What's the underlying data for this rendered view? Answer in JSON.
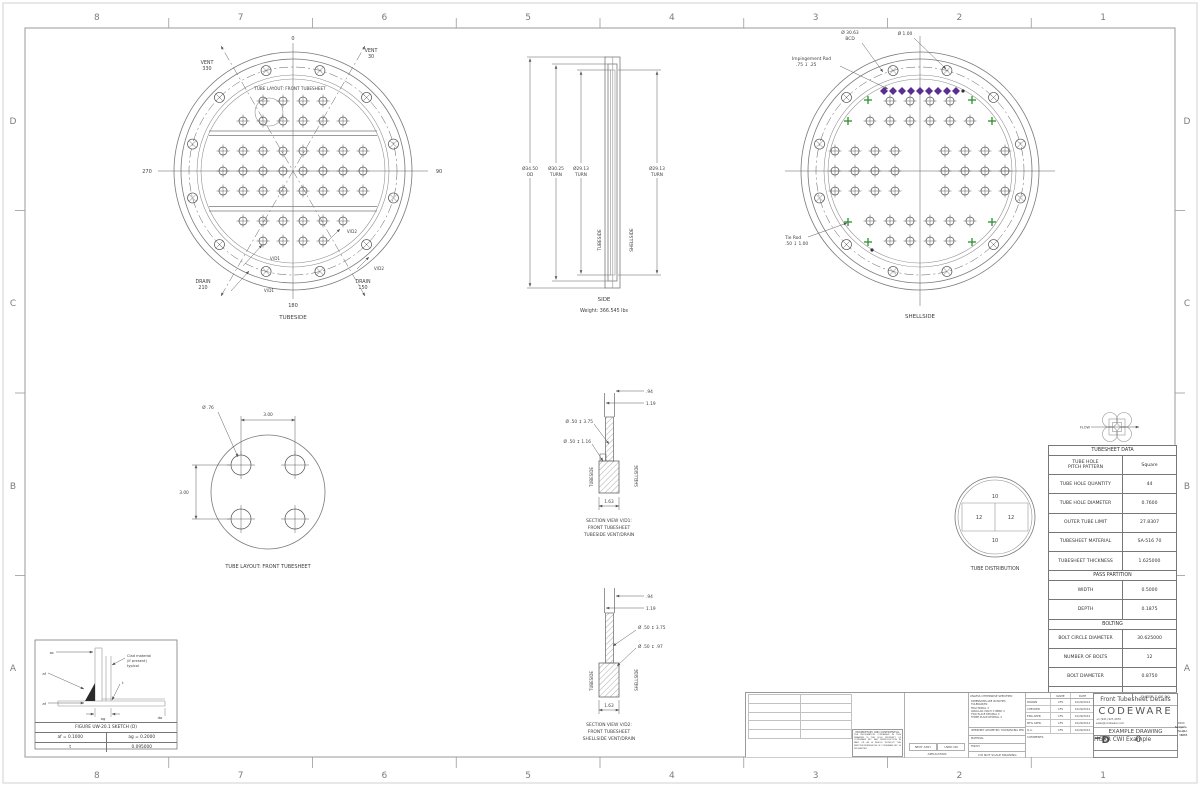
{
  "sheet": {
    "cols": [
      "8",
      "7",
      "6",
      "5",
      "4",
      "3",
      "2",
      "1"
    ],
    "rows": [
      "D",
      "C",
      "B",
      "A"
    ]
  },
  "tubeside": {
    "inner_title": "TUBE LAYOUT: FRONT TUBESHEET",
    "caption": "TUBESIDE",
    "angle_top": "0",
    "angle_right": "90",
    "angle_left": "270",
    "angle_bottom": "180",
    "vent_left": [
      "VENT",
      "330"
    ],
    "vent_right": [
      "VENT",
      "30"
    ],
    "drain_left": [
      "DRAIN",
      "210"
    ],
    "drain_right": [
      "DRAIN",
      "150"
    ],
    "vd1": "V/D1",
    "vd2": "V/D2"
  },
  "side": {
    "caption": "SIDE",
    "weight": "Weight: 366.545 lbs",
    "dim1": [
      "Ø34.50",
      "OD"
    ],
    "dim2": [
      "Ø30.25",
      "TURN"
    ],
    "dim3": [
      "Ø29.13",
      "TURN"
    ],
    "dim4": [
      "Ø29.13",
      "TURN"
    ],
    "tubeside": "TUBESIDE",
    "shellside": "SHELLSIDE"
  },
  "shellside": {
    "caption": "SHELLSIDE",
    "bcd": [
      "Ø 30.63",
      "BCD"
    ],
    "bolt_hole_dia": "Ø 1.00",
    "impingement": [
      "Impingement Rod",
      ".75 ↧ .25"
    ],
    "tie_rod": [
      "Tie Rod",
      ".50 ↧ 1.00"
    ]
  },
  "detail": {
    "caption": "TUBE LAYOUT: FRONT TUBESHEET",
    "hole_dia": "Ø .76",
    "dim_h": "3.00",
    "dim_v": "3.00"
  },
  "vd1": {
    "cap": [
      "SECTION VIEW V/D1:",
      "FRONT TUBESHEET",
      "TUBESIDE VENT/DRAIN"
    ],
    "d94": ".94",
    "d119": "1.19",
    "l1": "Ø .50 ↧ 3.75",
    "l2": "Ø .50 ↧ 1.16",
    "d163": "1.63",
    "ts": "TUBESIDE",
    "ss": "SHELLSIDE"
  },
  "vd2": {
    "cap": [
      "SECTION VIEW V/D2:",
      "FRONT TUBESHEET",
      "SHELLSIDE VENT/DRAIN"
    ],
    "d94": ".94",
    "d119": "1.19",
    "l1": "Ø .50 ↧ 3.75",
    "l2": "Ø .50 ↧ .97",
    "d163": "1.63",
    "ts": "TUBESIDE",
    "ss": "SHELLSIDE"
  },
  "dist": {
    "caption": "TUBE DISTRIBUTION",
    "top": "10",
    "left": "12",
    "right": "12",
    "bottom": "10"
  },
  "flow": {
    "label": "FLOW"
  },
  "uw20": {
    "title": "FIGURE UW-20.1 SKETCH (D)",
    "af_eq": "af = 0.1000",
    "ag_eq": "ag = 0.2000",
    "t_label": "t",
    "t_val": "0.095000",
    "ac": "ac",
    "af1": "af",
    "af2": "af",
    "ag": "ag",
    "do_l": "do",
    "t": "t",
    "clad": [
      "Clad material",
      "(if present)",
      "typical"
    ]
  },
  "table": {
    "title": "TUBESHEET DATA",
    "sections": [
      {
        "header": null,
        "rows": [
          [
            "TUBE HOLE\nPITCH PATTERN",
            "Square"
          ],
          [
            "TUBE HOLE QUANTITY",
            "44"
          ],
          [
            "TUBE HOLE DIAMETER",
            "0.7600"
          ],
          [
            "OUTER TUBE LIMIT",
            "27.8307"
          ],
          [
            "TUBESHEET MATERIAL",
            "SA-516 70"
          ],
          [
            "TUBESHEET THICKNESS",
            "1.625000"
          ]
        ]
      },
      {
        "header": "PASS PARTITION",
        "rows": [
          [
            "WIDTH",
            "0.5000"
          ],
          [
            "DEPTH",
            "0.1875"
          ]
        ]
      },
      {
        "header": "BOLTING",
        "rows": [
          [
            "BOLT CIRCLE DIAMETER",
            "30.625000"
          ],
          [
            "NUMBER OF BOLTS",
            "12"
          ],
          [
            "BOLT DIAMETER",
            "0.8750"
          ],
          [
            "BOLT HOLE DIAMETER",
            "1"
          ]
        ]
      }
    ]
  },
  "tb": {
    "unless_header": "UNLESS OTHERWISE SPECIFIED:",
    "unless_lines": "DIMENSIONS ARE IN INCHES\nTOLERANCES:\nFRACTIONAL ±\nANGULAR: MACH ±  BEND ±\nTWO PLACE DECIMAL    ±\nTHREE PLACE DECIMAL  ±",
    "interpret": "INTERPRET GEOMETRIC TOLERANCING PER:",
    "material": "MATERIAL",
    "finish": "FINISH",
    "dnsd": "DO NOT SCALE DRAWING",
    "next_assy": "NEXT ASSY",
    "used_on": "USED ON",
    "application": "APPLICATION",
    "prop_header": "PROPRIETARY AND CONFIDENTIAL",
    "prop_body": "THE INFORMATION CONTAINED IN THIS DRAWING IS THE SOLE PROPERTY OF CODEWARE INC. ANY REPRODUCTION IN PART OR AS A WHOLE WITHOUT THE WRITTEN PERMISSION OF CODEWARE INC. IS PROHIBITED.",
    "name": "NAME",
    "date": "DATE",
    "comments": "COMMENTS:",
    "approvals": [
      [
        "DRAWN",
        "CFS",
        "10/29/2012"
      ],
      [
        "CHECKED",
        "CFS",
        "10/29/2012"
      ],
      [
        "ENG APPR.",
        "CFS",
        "10/29/2012"
      ],
      [
        "MFG APPR.",
        "CFS",
        "10/29/2012"
      ],
      [
        "Q.A.",
        "CFS",
        "10/29/2012"
      ]
    ],
    "title": "Front Tubesheet Details",
    "company": "CODEWARE",
    "phone": "+1 (941) 927-2670",
    "addr1": "6500 Sawyer Loop Rd",
    "email": "sales@codeware.com",
    "addr2": "Sarasota, FL, USA 34238",
    "example": "EXAMPLE DRAWING",
    "size_l": "SIZE",
    "size": "D",
    "dwg_l": "DWG.  NO.",
    "dwg": "HGXR CWI Example",
    "rev_l": "REV",
    "rev": "0",
    "sheet": "SHEET 7 OF 20"
  },
  "patterns": {
    "tube_rows_tubeside": [
      {
        "y": -70,
        "xs": [
          -30,
          -10,
          10,
          30
        ]
      },
      {
        "y": -50,
        "xs": [
          -50,
          -30,
          -10,
          10,
          30,
          50
        ]
      },
      {
        "y": -20,
        "xs": [
          -70,
          -50,
          -30,
          -10,
          10,
          30,
          50,
          70
        ]
      },
      {
        "y": 0,
        "xs": [
          -70,
          -50,
          -30,
          -10,
          10,
          30,
          50,
          70
        ]
      },
      {
        "y": 20,
        "xs": [
          -70,
          -50,
          -30,
          -10,
          10,
          30,
          50,
          70
        ]
      },
      {
        "y": 50,
        "xs": [
          -50,
          -30,
          -10,
          10,
          30,
          50
        ]
      },
      {
        "y": 70,
        "xs": [
          -30,
          -10,
          10,
          30
        ]
      }
    ],
    "tube_rows_shellside": [
      {
        "y": -70,
        "xs": [
          -30,
          -10,
          10,
          30
        ]
      },
      {
        "y": -50,
        "xs": [
          -50,
          -30,
          -10,
          10,
          30,
          50
        ]
      },
      {
        "y": -20,
        "xs": [
          -85,
          -65,
          -45,
          -25,
          25,
          45,
          65,
          85
        ]
      },
      {
        "y": 0,
        "xs": [
          -85,
          -65,
          -45,
          -25,
          25,
          45,
          65,
          85
        ]
      },
      {
        "y": 20,
        "xs": [
          -85,
          -65,
          -45,
          -25,
          25,
          45,
          65,
          85
        ]
      },
      {
        "y": 50,
        "xs": [
          -50,
          -30,
          -10,
          10,
          30,
          50
        ]
      },
      {
        "y": 70,
        "xs": [
          -30,
          -10,
          10,
          30
        ]
      }
    ],
    "tie_rods": [
      [
        -52,
        -71
      ],
      [
        52,
        -71
      ],
      [
        -72,
        -50
      ],
      [
        72,
        -50
      ],
      [
        -72,
        51
      ],
      [
        72,
        51
      ],
      [
        -52,
        71
      ],
      [
        52,
        71
      ]
    ],
    "impingement": {
      "y": -80,
      "x0": -36,
      "step": 9,
      "count": 9
    },
    "dots": [
      [
        43,
        -80
      ],
      [
        -48,
        79
      ]
    ],
    "bolt_circle_r": 104,
    "bolt_angle_start": 15,
    "bolt_count": 12,
    "colors": {
      "impingement": "#5c2d91",
      "tie_rod": "#2f8f2f",
      "line": "#7a7a7a"
    }
  }
}
